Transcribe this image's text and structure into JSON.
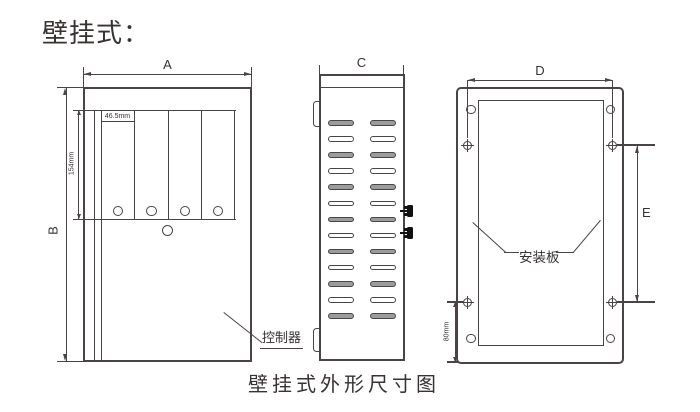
{
  "page": {
    "title": "壁挂式：",
    "caption": "壁挂式外形尺寸图"
  },
  "front_view": {
    "name": "控制器正视图",
    "width_dim": "A",
    "height_dim": "B",
    "slot_width": "46.5mm",
    "slot_height": "154mm",
    "callout_label": "控制器",
    "slot_count": 4
  },
  "side_view": {
    "width_dim": "C",
    "vent_rows": 13,
    "vent_cols": 2
  },
  "back_view": {
    "width_dim": "D",
    "height_dim": "E",
    "bottom_offset": "80mm",
    "callout_label": "安装板"
  },
  "colors": {
    "line": "#4a4444",
    "text": "#383231",
    "vent_fill": "#9c9c9c",
    "background": "#ffffff"
  }
}
